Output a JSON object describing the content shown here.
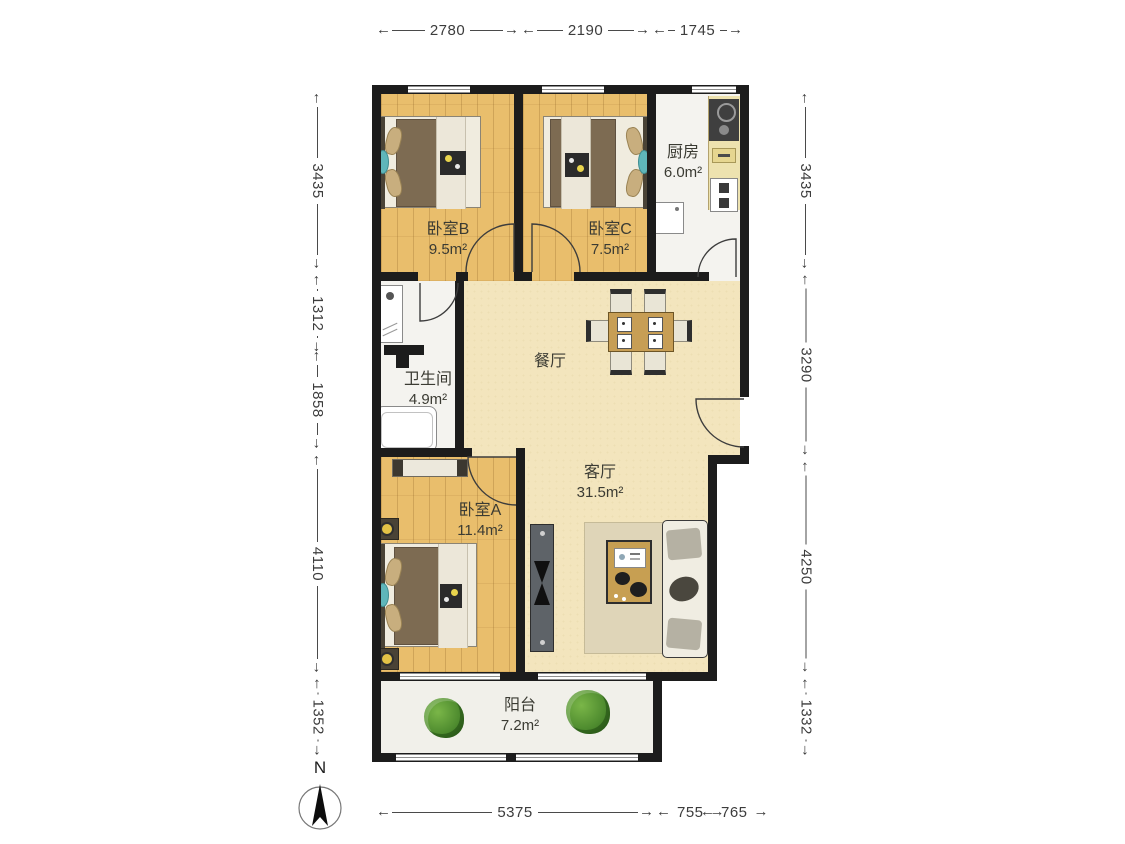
{
  "compass": {
    "label": "N"
  },
  "rooms": {
    "bedroom_b": {
      "name": "卧室B",
      "area": "9.5m²"
    },
    "bedroom_c": {
      "name": "卧室C",
      "area": "7.5m²"
    },
    "kitchen": {
      "name": "厨房",
      "area": "6.0m²"
    },
    "bathroom": {
      "name": "卫生间",
      "area": "4.9m²"
    },
    "dining": {
      "name": "餐厅"
    },
    "living": {
      "name": "客厅",
      "area": "31.5m²"
    },
    "bedroom_a": {
      "name": "卧室A",
      "area": "11.4m²"
    },
    "balcony": {
      "name": "阳台",
      "area": "7.2m²"
    }
  },
  "dimensions_mm": {
    "top": [
      "2780",
      "2190",
      "1745"
    ],
    "left": [
      "3435",
      "1312",
      "1858",
      "4110",
      "1352"
    ],
    "right": [
      "3435",
      "3290",
      "4250",
      "1332"
    ],
    "bottom": [
      "5375",
      "755",
      "765"
    ]
  },
  "colors": {
    "wall": "#1c1c1c",
    "wood_floor": "#e9be6c",
    "living_floor": "#f3e5bd",
    "tile_floor": "#f4f3ef",
    "dimension_text": "#3c3c3c",
    "duvet_brown": "#7d6b52",
    "accent_teal": "#5fb6ba",
    "plant_green": "#4d8a2e"
  }
}
